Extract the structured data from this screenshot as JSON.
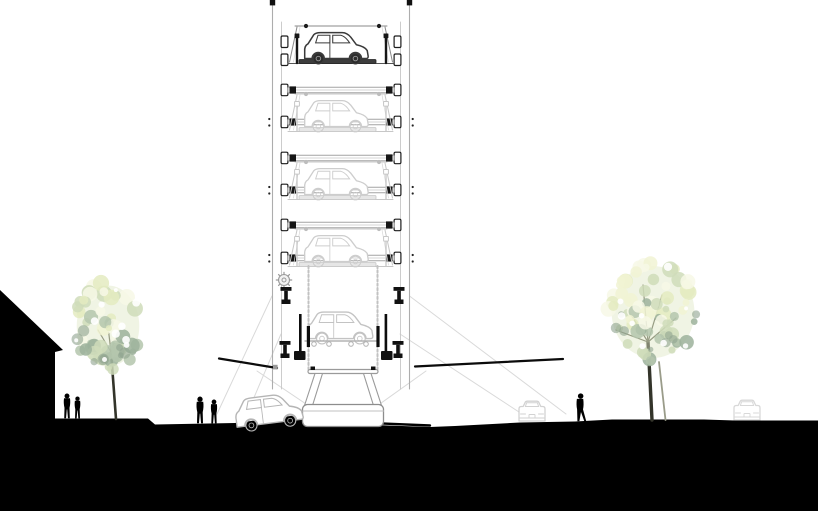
{
  "meta": {
    "title": "Architectural section drawing of an automated car-stacking parking tower with street context (trees, pedestrians, cars)",
    "background": "#ffffff"
  },
  "palette": {
    "ink": "#111111",
    "black": "#000000",
    "dark_line": "#3a3a3a",
    "mid_line": "#9a9a9a",
    "light_line": "#c7c7c7",
    "xlight_line": "#d9d9d9",
    "faint_car": "#c6c6c6",
    "fainter_car": "#d6d6d6",
    "trunk_dark": "#33342a",
    "trunk_mid": "#5c5e4e",
    "trunk_light": "#9a9c8a",
    "foliage": [
      "#f1f3d4",
      "#e4ebc1",
      "#cfdcba",
      "#b4c6ad",
      "#9cb29b",
      "#f7f8e6"
    ],
    "foliage_shadow": "#8fa38f",
    "foliage_base": "#dde7c3"
  },
  "canvas": {
    "width": 818,
    "height": 511
  },
  "tower": {
    "left_outer": 272.5,
    "left_inner": 281.5,
    "right_inner": 400.5,
    "right_outer": 409.5,
    "top": 2,
    "bottom": 389,
    "caps": [
      [
        269.8,
        0
      ],
      [
        406.8,
        0
      ]
    ],
    "bracket_cols": [
      284.5,
      397.5
    ],
    "top_bracket_rows": [
      36,
      54
    ],
    "beam_rows": [
      90,
      122,
      158,
      190,
      225,
      258
    ],
    "frame_dot_rows": [
      122,
      190,
      258
    ],
    "levels": [
      {
        "platform_y": 64,
        "style": "dark",
        "label": "top-level-car"
      },
      {
        "platform_y": 132,
        "style": "faint",
        "label": "level-4-car"
      },
      {
        "platform_y": 200,
        "style": "faint",
        "label": "level-3-car"
      },
      {
        "platform_y": 267,
        "style": "faint",
        "label": "level-2-car"
      }
    ],
    "entry_car": {
      "x": 341,
      "y": 339.5,
      "scale": 0.97
    },
    "gear": {
      "cx": 284,
      "cy": 280,
      "r": 5.5
    },
    "anchors": [
      [
        286,
        287
      ],
      [
        399,
        287
      ],
      [
        285,
        341
      ],
      [
        398,
        341
      ]
    ],
    "pistons": [
      [
        299,
        314,
        2.6,
        42
      ],
      [
        306.8,
        326,
        3.2,
        21
      ],
      [
        384.6,
        314,
        2.6,
        42
      ],
      [
        376.4,
        326,
        3.2,
        21
      ]
    ],
    "collars": [
      [
        294,
        351
      ],
      [
        381,
        351
      ]
    ],
    "chains": {
      "x": [
        308.5,
        377.5
      ],
      "y1": 266,
      "y2": 371
    }
  },
  "pedestal": {
    "bar": [
      308,
      369.5,
      70,
      4
    ],
    "caps": [
      [
        310.5,
        366.5
      ],
      [
        371,
        366.5
      ]
    ],
    "legs": [
      [
        [
          315,
          373.5
        ],
        [
          322.5,
          373.5
        ],
        [
          312.5,
          405.5
        ],
        [
          304.5,
          405.5
        ]
      ],
      [
        [
          363.5,
          373.5
        ],
        [
          371,
          373.5
        ],
        [
          381.5,
          405.5
        ],
        [
          373.5,
          405.5
        ]
      ]
    ],
    "base": [
      302.5,
      404.5,
      81,
      22
    ],
    "base_line_y": 411
  },
  "cables": [
    {
      "x1": 219,
      "y1": 358.5,
      "x2": 277,
      "y2": 368,
      "end_square": [
        273,
        364.8
      ]
    },
    {
      "x1": 415,
      "y1": 366.5,
      "x2": 563,
      "y2": 359,
      "end_square": null
    }
  ],
  "splay_lines": [
    [
      272,
      296,
      217,
      414
    ],
    [
      281,
      334,
      247,
      414
    ],
    [
      409.5,
      296,
      566,
      414
    ],
    [
      400,
      334,
      519,
      412
    ],
    [
      257,
      371,
      309,
      406
    ],
    [
      426,
      371,
      377,
      406
    ]
  ],
  "ground": {
    "points": [
      [
        0,
        418.5
      ],
      [
        148,
        418.5
      ],
      [
        155,
        424.5
      ],
      [
        235,
        423
      ],
      [
        302,
        414.5
      ],
      [
        312,
        416
      ],
      [
        330,
        423.5
      ],
      [
        430,
        427
      ],
      [
        455,
        426
      ],
      [
        520,
        422.5
      ],
      [
        575,
        421.5
      ],
      [
        612,
        419.5
      ],
      [
        704,
        419.5
      ],
      [
        735,
        420.5
      ],
      [
        818,
        420.5
      ],
      [
        818,
        511
      ],
      [
        0,
        511
      ]
    ],
    "front_line": [
      300,
      420,
      430,
      425.5
    ]
  },
  "building": {
    "points": [
      [
        0,
        290
      ],
      [
        63,
        350
      ],
      [
        55,
        352
      ],
      [
        55,
        419
      ],
      [
        0,
        419
      ]
    ]
  },
  "trees": [
    {
      "name": "tree-left",
      "cx": 108,
      "cy": 326,
      "rx": 34,
      "ry": 44,
      "blobs": 55,
      "seed": 7,
      "trunk": [
        [
          116,
          419
        ],
        [
          113.5,
          385
        ],
        [
          111,
          352
        ]
      ],
      "trunk_w": 2.6,
      "branches": [
        [
          111,
          352,
          98,
          330
        ],
        [
          111,
          352,
          107,
          318
        ],
        [
          111,
          352,
          120,
          326
        ],
        [
          111,
          352,
          126,
          340
        ]
      ]
    },
    {
      "name": "tree-right",
      "cx": 653,
      "cy": 312,
      "rx": 45,
      "ry": 50,
      "blobs": 72,
      "seed": 13,
      "trunk": [
        [
          652,
          420
        ],
        [
          650,
          380
        ],
        [
          648,
          342
        ]
      ],
      "trunk_w": 3.4,
      "trunk2": [
        [
          665.5,
          420
        ],
        [
          659,
          362
        ]
      ],
      "branches": [
        [
          648,
          342,
          628,
          310
        ],
        [
          648,
          342,
          643,
          285
        ],
        [
          648,
          342,
          662,
          295
        ],
        [
          648,
          342,
          676,
          318
        ],
        [
          648,
          342,
          616,
          330
        ]
      ]
    }
  ],
  "people": [
    {
      "name": "pedestrian-couple-left-a",
      "x": 67,
      "foot_y": 418.5,
      "h": 25,
      "pose": "standing"
    },
    {
      "name": "pedestrian-couple-left-b",
      "x": 77.5,
      "foot_y": 418.5,
      "h": 22,
      "pose": "standing"
    },
    {
      "name": "pedestrian-pair-center-a",
      "x": 200,
      "foot_y": 423.5,
      "h": 27,
      "pose": "standing"
    },
    {
      "name": "pedestrian-pair-center-b",
      "x": 214,
      "foot_y": 423.5,
      "h": 24,
      "pose": "standing"
    },
    {
      "name": "pedestrian-right-walking",
      "x": 580,
      "foot_y": 421.5,
      "h": 28,
      "pose": "walking"
    }
  ],
  "street_cars": [
    {
      "name": "car-entering-ramp",
      "type": "side",
      "x": 271,
      "y": 424,
      "rotate": -7,
      "scale": 1.0,
      "stroke": "#b5b5b5",
      "layer": "front"
    },
    {
      "name": "car-street-mid-right",
      "type": "rear",
      "x": 532,
      "y": 421.5,
      "stroke": "#d2d2d2",
      "layer": "behind"
    },
    {
      "name": "car-street-far-right",
      "type": "rear",
      "x": 747,
      "y": 420.5,
      "stroke": "#d8d8d8",
      "layer": "behind"
    }
  ]
}
